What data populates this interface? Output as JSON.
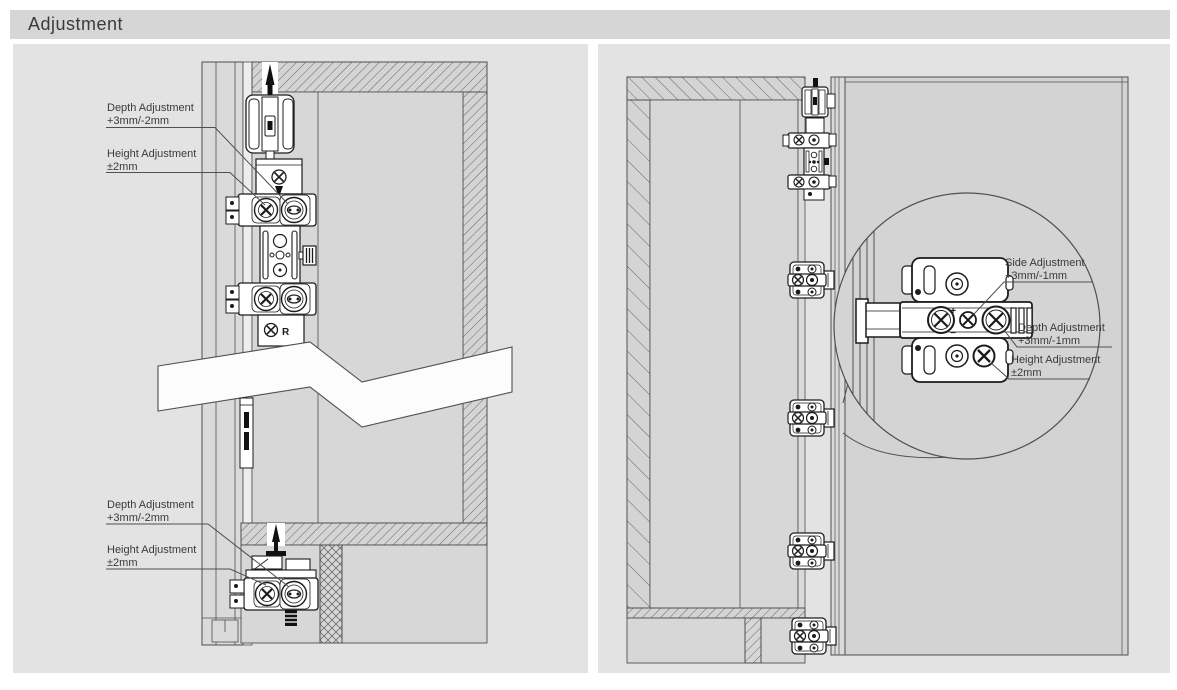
{
  "header": {
    "title": "Adjustment"
  },
  "left_panel": {
    "top_labels": [
      {
        "line1": "Depth Adjustment",
        "line2": "+3mm/-2mm"
      },
      {
        "line1": "Height Adjustment",
        "line2": "±2mm"
      }
    ],
    "bottom_labels": [
      {
        "line1": "Depth Adjustment",
        "line2": "+3mm/-2mm"
      },
      {
        "line1": "Height Adjustment",
        "line2": "±2mm"
      }
    ],
    "marks": {
      "r": "R"
    }
  },
  "right_panel": {
    "labels": [
      {
        "line1": "Side Adjustment",
        "line2": "+3mm/-1mm"
      },
      {
        "line1": "Depth Adjustment",
        "line2": "+3mm/-1mm"
      },
      {
        "line1": "Height Adjustment",
        "line2": "±2mm"
      }
    ],
    "marks": {
      "plus": "+",
      "minus": "−"
    }
  },
  "colors": {
    "title_bar_bg": "#d6d6d6",
    "panel_bg": "#e3e3e3",
    "drawing_fill": "#d4d4d4",
    "interior_fill": "#d7d7d7",
    "outline": "#4f4f4f",
    "hardware_outline": "#1c1c1c",
    "text": "#3a3a3a"
  }
}
